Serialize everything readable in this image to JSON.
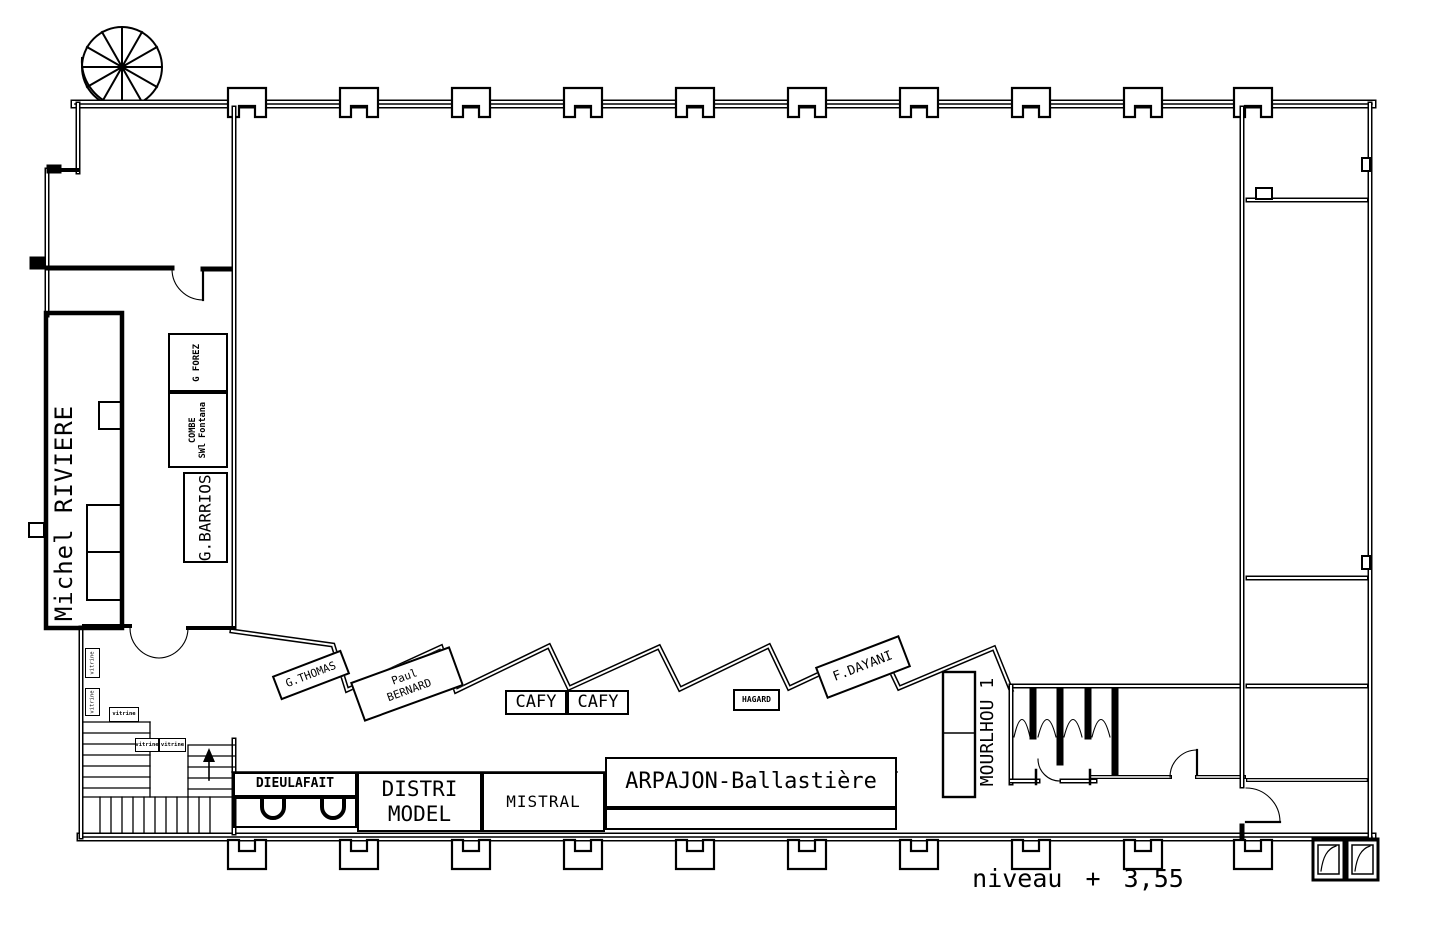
{
  "plan": {
    "colors": {
      "ink": "#000000",
      "paper": "#ffffff"
    },
    "level_label": "niveau + 3,55",
    "labels": {
      "michel_riviere": "Michel RIVIERE",
      "g_forez": "G FOREZ",
      "combe_line1": "COMBE",
      "combe_line2": "SWl Fontana",
      "g_barrios": "G.BARRIOS",
      "vitrine_side_1": "vitrine",
      "vitrine_side_2": "vitrine",
      "vitrine_1": "vitrine",
      "vitrine_2": "vitrine",
      "vitrine_3": "vitrine",
      "g_thomas": "G.THOMAS",
      "paul_bernard_line1": "Paul",
      "paul_bernard_line2": "BERNARD",
      "cafy_left": "CAFY",
      "cafy_right": "CAFY",
      "hagard": "HAGARD",
      "f_dayani": "F.DAYANI",
      "mourlhou": "MOURLHOU 1",
      "dieulafait": "DIEULAFAIT",
      "distri_line1": "DISTRI",
      "distri_line2": "MODEL",
      "mistral": "MISTRAL",
      "arpajon": "ARPAJON-Ballastière"
    }
  }
}
